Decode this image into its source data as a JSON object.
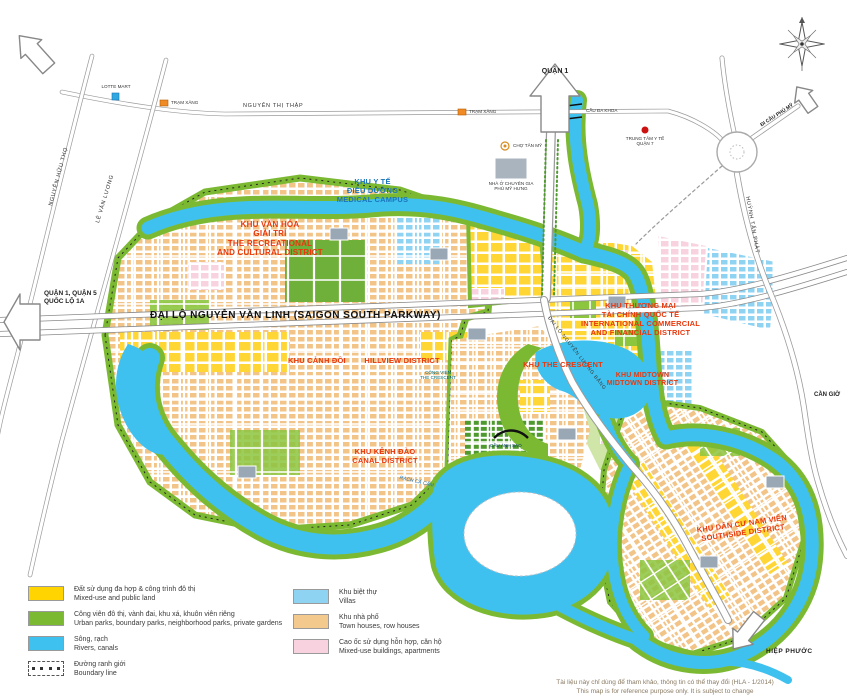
{
  "map": {
    "arrows": {
      "quan1": "QUẬN 1",
      "quan1_quan5": "QUẬN 1, QUẬN 5",
      "quoc_lo_1a": "QUỐC LỘ 1A",
      "hiep_phuoc": "HIỆP PHƯỚC",
      "di_cau_phu_my": "ĐI CẦU PHÚ MỸ",
      "can_gio": "CẦN GIỜ"
    },
    "roads": {
      "parkway": "ĐẠI LỘ NGUYỄN VĂN LINH (SAIGON SOUTH PARKWAY)",
      "nguyen_thi_thap": "NGUYỄN THỊ THẬP",
      "nguyen_huu_tho": "NGUYỄN HỮU THỌ",
      "le_van_luong": "LÊ VĂN LƯƠNG",
      "huynh_tan_phat": "HUỲNH TẤN PHÁT",
      "nguyen_luong_bang": "ĐẠI LỘ NGUYỄN LƯƠNG BẰNG"
    },
    "districts": [
      {
        "id": "medical",
        "lines": [
          "KHU Y TẾ",
          "ĐIỀU DƯỠNG",
          "MEDICAL CAMPUS"
        ]
      },
      {
        "id": "recreational",
        "lines": [
          "KHU VĂN HÓA",
          "GIẢI TRÍ",
          "THE RECREATIONAL",
          "AND CULTURAL DISTRICT"
        ]
      },
      {
        "id": "hillview",
        "lines": [
          "KHU CẢNH ĐỒI",
          "HILLVIEW DISTRICT"
        ]
      },
      {
        "id": "crescent",
        "lines": [
          "KHU THE CRESCENT"
        ]
      },
      {
        "id": "commercial",
        "lines": [
          "KHU THƯƠNG MẠI",
          "TÀI CHÍNH QUỐC TẾ",
          "INTERNATIONAL COMMERCIAL",
          "AND FINANCIAL DISTRICT"
        ]
      },
      {
        "id": "canal",
        "lines": [
          "KHU KÊNH ĐÀO",
          "CANAL DISTRICT"
        ]
      },
      {
        "id": "midtown",
        "lines": [
          "KHU MIDTOWN",
          "MIDTOWN DISTRICT"
        ]
      },
      {
        "id": "southside",
        "lines": [
          "KHU DÂN CƯ NAM VIÊN",
          "SOUTHSIDE DISTRICT"
        ]
      }
    ],
    "pois": {
      "lotte": "LOTTE MART",
      "tram_xang_1": "TRẠM XĂNG",
      "tram_xang_2": "TRẠM XĂNG",
      "cho_tan_my": "CHỢ TÂN MỸ",
      "ttyt": [
        "TRUNG TÂM Y TẾ",
        "QUẬN 7"
      ],
      "nha_o": [
        "NHÀ Ở CHUYÊN GIA",
        "PHÚ MỸ HƯNG"
      ]
    },
    "water_labels": {
      "rach_ca_cam": "RẠCH CẢ CẤM"
    },
    "bridges": {
      "cau_anh_sao": "CẦU ÁNH SAO",
      "cau_da_khoa": "CẦU ĐA KHOA"
    },
    "crescent_caption": [
      "CÔNG VIÊN",
      "THE CRESCENT"
    ]
  },
  "legend": {
    "left": [
      {
        "vi": "Đất sử dụng đa hợp & công trình đô thị",
        "en": "Mixed-use and public land",
        "color": "#FFD400"
      },
      {
        "vi": "Công viên đô thị, vành đai, khu xá, khuôn viên riêng",
        "en": "Urban parks, boundary parks, neighborhood parks, private gardens",
        "color": "#7CB933"
      },
      {
        "vi": "Sông, rạch",
        "en": "Rivers, canals",
        "color": "#3FC1F0"
      },
      {
        "vi": "Đường ranh giới",
        "en": "Boundary line",
        "color": "boundary"
      }
    ],
    "right": [
      {
        "vi": "Khu biệt thự",
        "en": "Villas",
        "color": "#8FD3F3"
      },
      {
        "vi": "Khu nhà phố",
        "en": "Town houses, row houses",
        "color": "#F4C98E"
      },
      {
        "vi": "Cao ốc sử dụng hỗn hợp, căn hộ",
        "en": "Mixed-use buildings, apartments",
        "color": "#F8D3DF"
      }
    ]
  },
  "disclaimer": {
    "line1": "Tài liệu này chỉ dùng để tham khảo, thông tin có thể thay đổi (HLA - 1/2014)",
    "line2": "This map is for reference purpose only. It is subject to change"
  }
}
